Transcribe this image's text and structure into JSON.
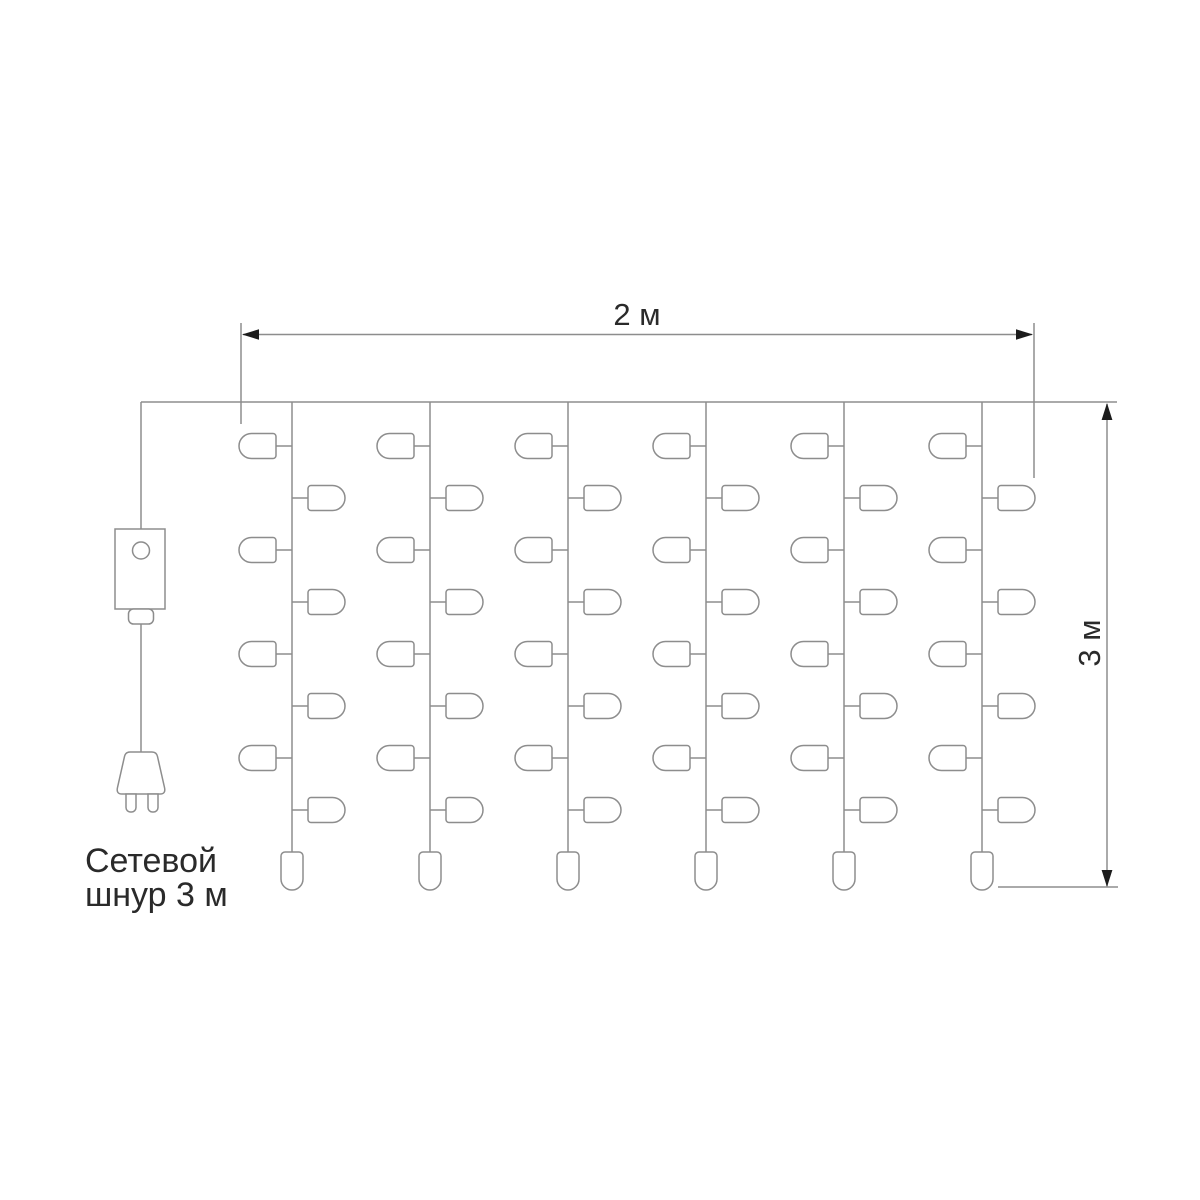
{
  "labels": {
    "width_dimension": "2 м",
    "height_dimension": "3 м",
    "cord_label_line1": "Сетевой",
    "cord_label_line2": "шнур 3 м"
  },
  "curtain": {
    "strand_count": 6,
    "side_bulbs_per_strand": 8,
    "end_bulbs_per_strand": 1
  },
  "colors": {
    "line": "#8d8d8d",
    "arrowhead": "#1c1c1c",
    "text": "#2a2a2a",
    "background": "#ffffff"
  }
}
